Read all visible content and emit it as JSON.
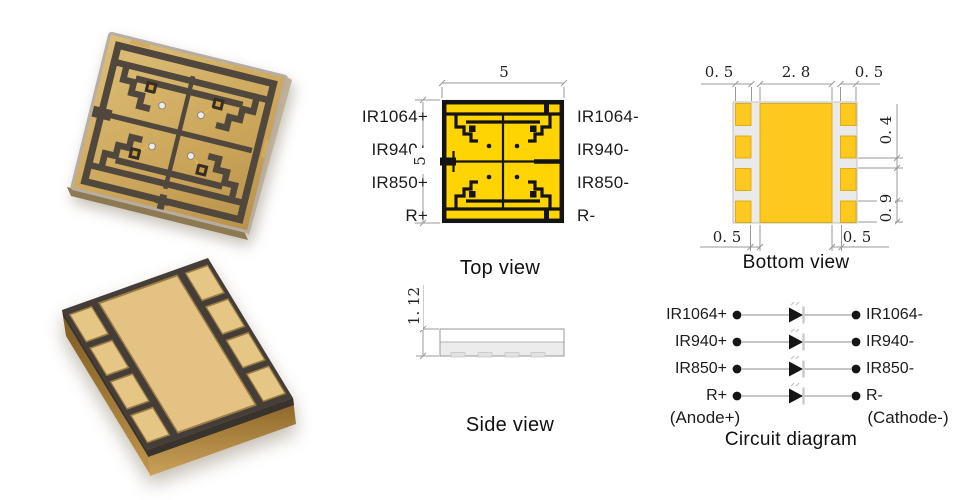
{
  "top_view": {
    "caption": "Top view",
    "dim_top": "5",
    "dim_left": "5",
    "pins_left": [
      "IR1064+",
      "IR940+",
      "IR850+",
      "R+"
    ],
    "pins_right": [
      "IR1064-",
      "IR940-",
      "IR850-",
      "R-"
    ]
  },
  "side_view": {
    "caption": "Side view",
    "dim_height": "1. 12"
  },
  "bottom_view": {
    "caption": "Bottom view",
    "dim_top_left": "0. 5",
    "dim_top_center": "2. 8",
    "dim_top_right": "0. 5",
    "dim_right_upper": "0. 4",
    "dim_right_lower": "0. 9",
    "dim_bottom_left": "0. 5",
    "dim_bottom_right": "0. 5"
  },
  "circuit": {
    "caption": "Circuit diagram",
    "anode_label": "(Anode+)",
    "cathode_label": "(Cathode-)",
    "rows": [
      {
        "left": "IR1064+",
        "right": "IR1064-"
      },
      {
        "left": "IR940+",
        "right": "IR940-"
      },
      {
        "left": "IR850+",
        "right": "IR850-"
      },
      {
        "left": "R+",
        "right": "R-"
      }
    ]
  },
  "photos": {
    "top": "package-top-photo",
    "bottom": "package-bottom-photo"
  },
  "colors": {
    "drawing_yellow": "#FFD400",
    "pad_yellow": "#FFC81E",
    "trace_black": "#141414",
    "dim_gray": "#999999",
    "photo_gold": "#D3AF63",
    "photo_dark_face": "#453E38",
    "circuit_line_gray": "#B3B3B3"
  }
}
